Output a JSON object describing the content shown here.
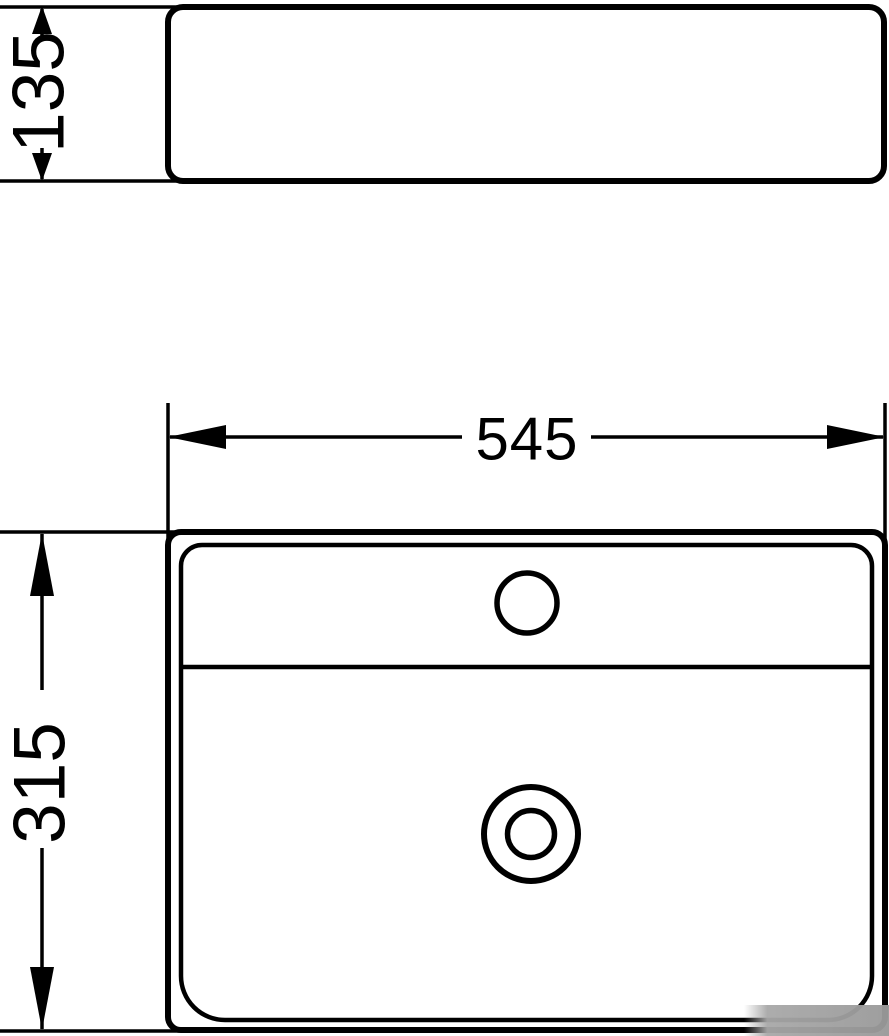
{
  "figure": {
    "background": "#ffffff",
    "line_color": "#000000",
    "watermark_color": "#a8a8a8"
  },
  "dimensions": {
    "height_label": "135",
    "width_label": "545",
    "depth_label": "315"
  }
}
